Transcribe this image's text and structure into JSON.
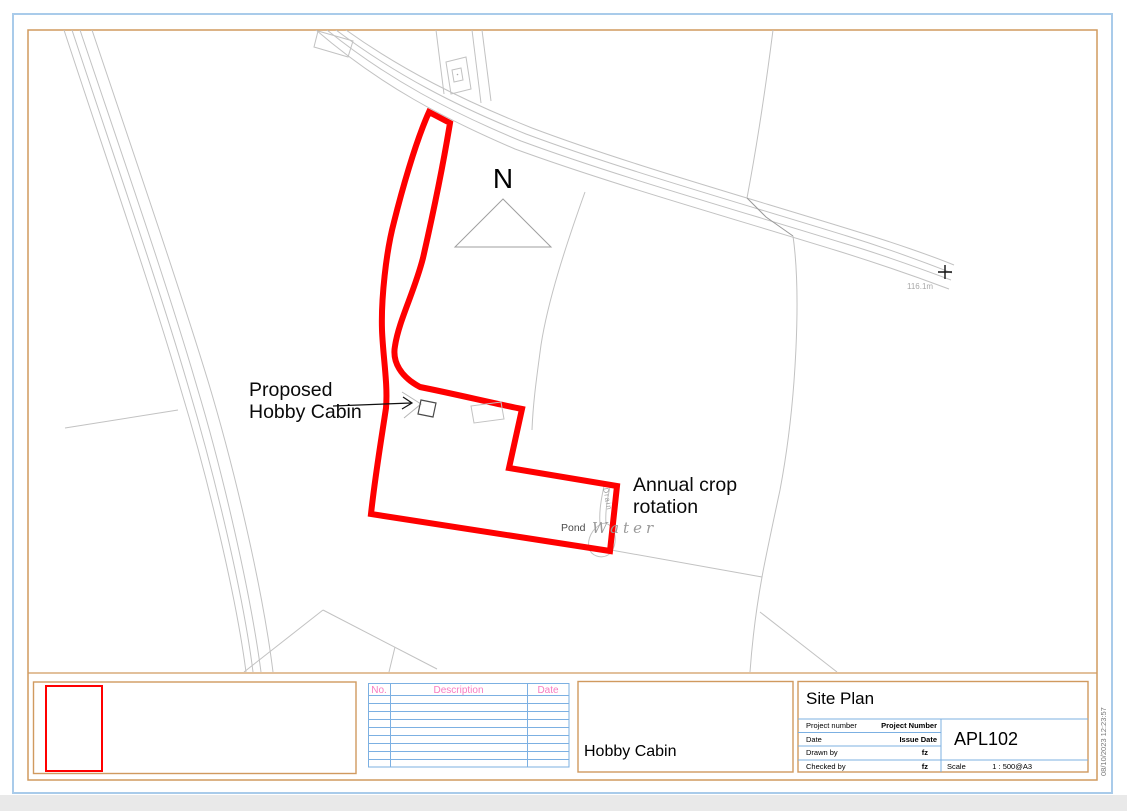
{
  "map": {
    "north_label": "N",
    "proposed_cabin_label": [
      "Proposed",
      "Hobby Cabin"
    ],
    "crop_label": [
      "Annual crop",
      "rotation"
    ],
    "pond_label": "Pond",
    "water_label": "Water",
    "drain_label": "Drain",
    "spot_height": "116.1m"
  },
  "revision_table": {
    "headers": [
      "No.",
      "Description",
      "Date"
    ]
  },
  "title_block": {
    "view_title": "Site Plan",
    "project_name": "Hobby Cabin",
    "fields": [
      {
        "label": "Project number",
        "value": "Project Number"
      },
      {
        "label": "Date",
        "value": "Issue Date"
      },
      {
        "label": "Drawn by",
        "value": "fz"
      },
      {
        "label": "Checked by",
        "value": "fz"
      }
    ],
    "sheet_number": "APL102",
    "scale_label": "Scale",
    "scale_value": "1 : 500@A3"
  },
  "plot_stamp": "08/10/2023 12:23:57",
  "colors": {
    "boundary_red": "#fe0000",
    "sheet_border_orange": "#d09a5f",
    "page_border_blue": "#a9cbea",
    "table_grid_blue": "#7cb0e2",
    "header_pink": "#f87cc1"
  }
}
